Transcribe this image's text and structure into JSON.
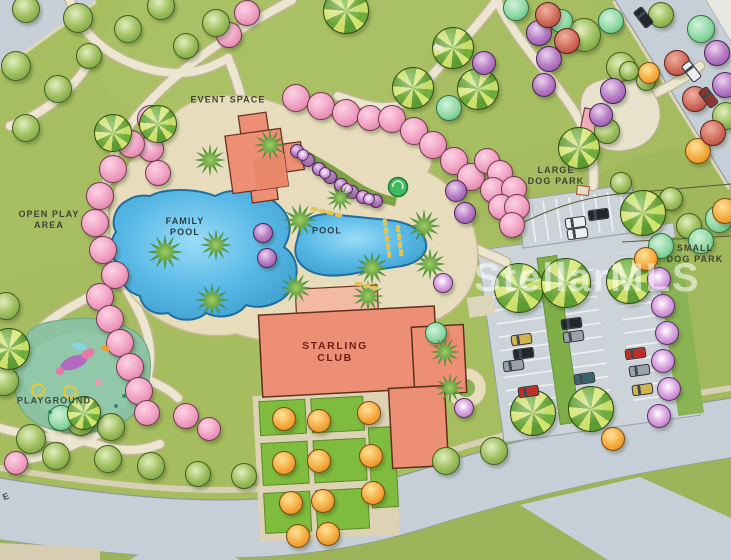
{
  "labels": {
    "event_space": "EVENT SPACE",
    "open_play_line1": "OPEN PLAY",
    "open_play_line2": "AREA",
    "family_pool_line1": "FAMILY",
    "family_pool_line2": "POOL",
    "pool": "POOL",
    "starling_club_line1": "STARLING",
    "starling_club_line2": "CLUB",
    "playground": "PLAYGROUND",
    "large_dog_park_line1": "LARGE",
    "large_dog_park_line2": "DOG PARK",
    "small_dog_park_line1": "SMALL",
    "small_dog_park_line2": "DOG PARK",
    "street_partial": "E",
    "watermark": "StellarMLS"
  },
  "colors": {
    "lawn": "#a6bd60",
    "verge": "#9cb35a",
    "road": "#c6cfd7",
    "lot": "#ccd4da",
    "deck": "#e7dcbb",
    "path": "#ece6d0",
    "water": "#57b8e6",
    "water_edge": "#1f6e9e",
    "building": "#ec8f74",
    "building_light": "#f2baa2",
    "building_stroke": "#5f2f1c",
    "playground": "#8cc2a2",
    "median_green": "#7fae48",
    "pink_tree": "#f3a8c8",
    "label_dark": "#3f4433",
    "label_pool": "#2c3b42",
    "label_club": "#6e2018",
    "label_playground": "#39503c",
    "watermark": "rgba(255,255,255,0.55)",
    "car_colors": {
      "yellow": "#d2b44a",
      "black": "#23272c",
      "gray": "#9aa1a8",
      "red": "#bf2e26",
      "teal": "#39646e",
      "white": "#eceef0",
      "darkred": "#8d3531"
    }
  },
  "trees": [
    {
      "t": "pink",
      "x": 295,
      "y": 97,
      "r": 13
    },
    {
      "t": "pink",
      "x": 320,
      "y": 105,
      "r": 13
    },
    {
      "t": "pink",
      "x": 345,
      "y": 112,
      "r": 13
    },
    {
      "t": "pink",
      "x": 369,
      "y": 117,
      "r": 12
    },
    {
      "t": "pink",
      "x": 391,
      "y": 118,
      "r": 13
    },
    {
      "t": "pink",
      "x": 413,
      "y": 130,
      "r": 13
    },
    {
      "t": "pink",
      "x": 432,
      "y": 144,
      "r": 13
    },
    {
      "t": "pink",
      "x": 453,
      "y": 160,
      "r": 13
    },
    {
      "t": "pink",
      "x": 470,
      "y": 176,
      "r": 13
    },
    {
      "t": "pink",
      "x": 486,
      "y": 160,
      "r": 12
    },
    {
      "t": "pink",
      "x": 499,
      "y": 172,
      "r": 12
    },
    {
      "t": "pink",
      "x": 492,
      "y": 189,
      "r": 12
    },
    {
      "t": "pink",
      "x": 513,
      "y": 188,
      "r": 12
    },
    {
      "t": "pink",
      "x": 500,
      "y": 206,
      "r": 12
    },
    {
      "t": "pink",
      "x": 516,
      "y": 206,
      "r": 12
    },
    {
      "t": "pink",
      "x": 511,
      "y": 224,
      "r": 12
    },
    {
      "t": "pink",
      "x": 246,
      "y": 12,
      "r": 12
    },
    {
      "t": "pink",
      "x": 228,
      "y": 34,
      "r": 12
    },
    {
      "t": "pink",
      "x": 150,
      "y": 148,
      "r": 12
    },
    {
      "t": "pink",
      "x": 157,
      "y": 172,
      "r": 12
    },
    {
      "t": "pink",
      "x": 150,
      "y": 118,
      "r": 13
    },
    {
      "t": "pink",
      "x": 130,
      "y": 143,
      "r": 13
    },
    {
      "t": "pink",
      "x": 112,
      "y": 168,
      "r": 13
    },
    {
      "t": "pink",
      "x": 99,
      "y": 195,
      "r": 13
    },
    {
      "t": "pink",
      "x": 94,
      "y": 222,
      "r": 13
    },
    {
      "t": "pink",
      "x": 102,
      "y": 249,
      "r": 13
    },
    {
      "t": "pink",
      "x": 114,
      "y": 274,
      "r": 13
    },
    {
      "t": "pink",
      "x": 99,
      "y": 296,
      "r": 13
    },
    {
      "t": "pink",
      "x": 109,
      "y": 318,
      "r": 13
    },
    {
      "t": "pink",
      "x": 119,
      "y": 342,
      "r": 13
    },
    {
      "t": "pink",
      "x": 129,
      "y": 366,
      "r": 13
    },
    {
      "t": "pink",
      "x": 138,
      "y": 390,
      "r": 13
    },
    {
      "t": "pink",
      "x": 146,
      "y": 412,
      "r": 12
    },
    {
      "t": "pink",
      "x": 185,
      "y": 415,
      "r": 12
    },
    {
      "t": "pink",
      "x": 208,
      "y": 428,
      "r": 11
    },
    {
      "t": "pink",
      "x": 15,
      "y": 462,
      "r": 11
    },
    {
      "t": "green",
      "x": 25,
      "y": 8,
      "r": 13
    },
    {
      "t": "green",
      "x": 77,
      "y": 17,
      "r": 14
    },
    {
      "t": "green",
      "x": 15,
      "y": 65,
      "r": 14
    },
    {
      "t": "green",
      "x": 57,
      "y": 88,
      "r": 13
    },
    {
      "t": "green",
      "x": 88,
      "y": 55,
      "r": 12
    },
    {
      "t": "green",
      "x": 127,
      "y": 28,
      "r": 13
    },
    {
      "t": "green",
      "x": 160,
      "y": 5,
      "r": 13
    },
    {
      "t": "green",
      "x": 25,
      "y": 127,
      "r": 13
    },
    {
      "t": "green",
      "x": 215,
      "y": 22,
      "r": 13
    },
    {
      "t": "green",
      "x": 185,
      "y": 45,
      "r": 12
    },
    {
      "t": "green",
      "x": 5,
      "y": 305,
      "r": 13
    },
    {
      "t": "green",
      "x": 3,
      "y": 380,
      "r": 14
    },
    {
      "t": "green",
      "x": 80,
      "y": 420,
      "r": 14
    },
    {
      "t": "green",
      "x": 110,
      "y": 426,
      "r": 13
    },
    {
      "t": "green",
      "x": 30,
      "y": 438,
      "r": 14
    },
    {
      "t": "green",
      "x": 55,
      "y": 455,
      "r": 13
    },
    {
      "t": "green",
      "x": 107,
      "y": 458,
      "r": 13
    },
    {
      "t": "green",
      "x": 150,
      "y": 465,
      "r": 13
    },
    {
      "t": "green",
      "x": 197,
      "y": 473,
      "r": 12
    },
    {
      "t": "green",
      "x": 243,
      "y": 475,
      "r": 12
    },
    {
      "t": "green",
      "x": 445,
      "y": 460,
      "r": 13
    },
    {
      "t": "green",
      "x": 493,
      "y": 450,
      "r": 13
    },
    {
      "t": "green",
      "x": 583,
      "y": 34,
      "r": 16
    },
    {
      "t": "green",
      "x": 620,
      "y": 66,
      "r": 14
    },
    {
      "t": "green",
      "x": 606,
      "y": 130,
      "r": 12
    },
    {
      "t": "green",
      "x": 725,
      "y": 115,
      "r": 13
    },
    {
      "t": "green",
      "x": 660,
      "y": 14,
      "r": 12
    },
    {
      "t": "green",
      "x": 620,
      "y": 182,
      "r": 10
    },
    {
      "t": "green",
      "x": 670,
      "y": 198,
      "r": 11
    },
    {
      "t": "green",
      "x": 688,
      "y": 225,
      "r": 12
    },
    {
      "t": "green",
      "x": 628,
      "y": 70,
      "r": 9
    },
    {
      "t": "green",
      "x": 645,
      "y": 80,
      "r": 9
    },
    {
      "t": "mint",
      "x": 448,
      "y": 107,
      "r": 12
    },
    {
      "t": "mint",
      "x": 515,
      "y": 7,
      "r": 12
    },
    {
      "t": "mint",
      "x": 610,
      "y": 20,
      "r": 12
    },
    {
      "t": "mint",
      "x": 700,
      "y": 28,
      "r": 13
    },
    {
      "t": "mint",
      "x": 718,
      "y": 218,
      "r": 13
    },
    {
      "t": "mint",
      "x": 700,
      "y": 240,
      "r": 12
    },
    {
      "t": "mint",
      "x": 660,
      "y": 245,
      "r": 12
    },
    {
      "t": "mint",
      "x": 435,
      "y": 332,
      "r": 10
    },
    {
      "t": "mint",
      "x": 60,
      "y": 417,
      "r": 12
    },
    {
      "t": "mint",
      "x": 560,
      "y": 20,
      "r": 11
    },
    {
      "t": "pinwheel",
      "x": 112,
      "y": 132,
      "r": 18
    },
    {
      "t": "pinwheel",
      "x": 157,
      "y": 123,
      "r": 18
    },
    {
      "t": "pinwheel",
      "x": 345,
      "y": 10,
      "r": 22
    },
    {
      "t": "pinwheel",
      "x": 452,
      "y": 47,
      "r": 20
    },
    {
      "t": "pinwheel",
      "x": 412,
      "y": 87,
      "r": 20
    },
    {
      "t": "pinwheel",
      "x": 477,
      "y": 88,
      "r": 20
    },
    {
      "t": "pinwheel",
      "x": 8,
      "y": 348,
      "r": 20
    },
    {
      "t": "pinwheel",
      "x": 83,
      "y": 412,
      "r": 16
    },
    {
      "t": "pinwheel",
      "x": 518,
      "y": 287,
      "r": 24
    },
    {
      "t": "pinwheel",
      "x": 565,
      "y": 282,
      "r": 24
    },
    {
      "t": "pinwheel",
      "x": 532,
      "y": 412,
      "r": 22
    },
    {
      "t": "pinwheel",
      "x": 590,
      "y": 408,
      "r": 22
    },
    {
      "t": "pinwheel",
      "x": 578,
      "y": 147,
      "r": 20
    },
    {
      "t": "pinwheel",
      "x": 642,
      "y": 212,
      "r": 22
    },
    {
      "t": "pinwheel",
      "x": 628,
      "y": 280,
      "r": 22
    },
    {
      "t": "purple",
      "x": 483,
      "y": 62,
      "r": 11
    },
    {
      "t": "purple",
      "x": 538,
      "y": 32,
      "r": 12
    },
    {
      "t": "purple",
      "x": 548,
      "y": 58,
      "r": 12
    },
    {
      "t": "purple",
      "x": 543,
      "y": 84,
      "r": 11
    },
    {
      "t": "purple",
      "x": 612,
      "y": 90,
      "r": 12
    },
    {
      "t": "purple",
      "x": 600,
      "y": 114,
      "r": 11
    },
    {
      "t": "purple",
      "x": 716,
      "y": 52,
      "r": 12
    },
    {
      "t": "purple",
      "x": 724,
      "y": 84,
      "r": 12
    },
    {
      "t": "purple",
      "x": 455,
      "y": 190,
      "r": 10
    },
    {
      "t": "purple",
      "x": 464,
      "y": 212,
      "r": 10
    },
    {
      "t": "purple",
      "x": 262,
      "y": 232,
      "r": 9
    },
    {
      "t": "purple",
      "x": 266,
      "y": 257,
      "r": 9
    },
    {
      "t": "purple",
      "x": 296,
      "y": 150,
      "r": 6
    },
    {
      "t": "purple",
      "x": 307,
      "y": 159,
      "r": 6
    },
    {
      "t": "purple",
      "x": 318,
      "y": 168,
      "r": 6
    },
    {
      "t": "purple",
      "x": 329,
      "y": 176,
      "r": 6
    },
    {
      "t": "purple",
      "x": 340,
      "y": 184,
      "r": 6
    },
    {
      "t": "purple",
      "x": 351,
      "y": 191,
      "r": 6
    },
    {
      "t": "purple",
      "x": 362,
      "y": 196,
      "r": 6
    },
    {
      "t": "purple",
      "x": 375,
      "y": 200,
      "r": 6
    },
    {
      "t": "pwhite",
      "x": 302,
      "y": 154,
      "r": 5
    },
    {
      "t": "pwhite",
      "x": 324,
      "y": 172,
      "r": 5
    },
    {
      "t": "pwhite",
      "x": 346,
      "y": 188,
      "r": 5
    },
    {
      "t": "pwhite",
      "x": 368,
      "y": 198,
      "r": 5
    },
    {
      "t": "pwhite",
      "x": 658,
      "y": 278,
      "r": 11
    },
    {
      "t": "pwhite",
      "x": 662,
      "y": 305,
      "r": 11
    },
    {
      "t": "pwhite",
      "x": 666,
      "y": 332,
      "r": 11
    },
    {
      "t": "pwhite",
      "x": 662,
      "y": 360,
      "r": 11
    },
    {
      "t": "pwhite",
      "x": 668,
      "y": 388,
      "r": 11
    },
    {
      "t": "pwhite",
      "x": 658,
      "y": 415,
      "r": 11
    },
    {
      "t": "pwhite",
      "x": 442,
      "y": 282,
      "r": 9
    },
    {
      "t": "pwhite",
      "x": 463,
      "y": 407,
      "r": 9
    },
    {
      "t": "orange",
      "x": 283,
      "y": 418,
      "r": 11
    },
    {
      "t": "orange",
      "x": 318,
      "y": 420,
      "r": 11
    },
    {
      "t": "orange",
      "x": 368,
      "y": 412,
      "r": 11
    },
    {
      "t": "orange",
      "x": 283,
      "y": 462,
      "r": 11
    },
    {
      "t": "orange",
      "x": 318,
      "y": 460,
      "r": 11
    },
    {
      "t": "orange",
      "x": 370,
      "y": 455,
      "r": 11
    },
    {
      "t": "orange",
      "x": 290,
      "y": 502,
      "r": 11
    },
    {
      "t": "orange",
      "x": 322,
      "y": 500,
      "r": 11
    },
    {
      "t": "orange",
      "x": 372,
      "y": 492,
      "r": 11
    },
    {
      "t": "orange",
      "x": 297,
      "y": 535,
      "r": 11
    },
    {
      "t": "orange",
      "x": 327,
      "y": 533,
      "r": 11
    },
    {
      "t": "orange",
      "x": 697,
      "y": 150,
      "r": 12
    },
    {
      "t": "orange",
      "x": 645,
      "y": 258,
      "r": 11
    },
    {
      "t": "orange",
      "x": 724,
      "y": 210,
      "r": 12
    },
    {
      "t": "orange",
      "x": 648,
      "y": 72,
      "r": 10
    },
    {
      "t": "orange",
      "x": 612,
      "y": 438,
      "r": 11
    },
    {
      "t": "red",
      "x": 547,
      "y": 14,
      "r": 12
    },
    {
      "t": "red",
      "x": 566,
      "y": 40,
      "r": 12
    },
    {
      "t": "red",
      "x": 676,
      "y": 62,
      "r": 12
    },
    {
      "t": "red",
      "x": 694,
      "y": 98,
      "r": 12
    },
    {
      "t": "red",
      "x": 712,
      "y": 132,
      "r": 12
    },
    {
      "t": "palm",
      "x": 300,
      "y": 220,
      "r": 17
    },
    {
      "t": "palm",
      "x": 340,
      "y": 198,
      "r": 14
    },
    {
      "t": "palm",
      "x": 372,
      "y": 268,
      "r": 17
    },
    {
      "t": "palm",
      "x": 424,
      "y": 226,
      "r": 17
    },
    {
      "t": "palm",
      "x": 430,
      "y": 264,
      "r": 16
    },
    {
      "t": "palm",
      "x": 368,
      "y": 296,
      "r": 16
    },
    {
      "t": "palm",
      "x": 296,
      "y": 288,
      "r": 16
    },
    {
      "t": "palm",
      "x": 165,
      "y": 252,
      "r": 18
    },
    {
      "t": "palm",
      "x": 216,
      "y": 245,
      "r": 16
    },
    {
      "t": "palm",
      "x": 212,
      "y": 300,
      "r": 17
    },
    {
      "t": "palm",
      "x": 210,
      "y": 160,
      "r": 16
    },
    {
      "t": "palm",
      "x": 270,
      "y": 145,
      "r": 16
    },
    {
      "t": "palm",
      "x": 445,
      "y": 352,
      "r": 15
    },
    {
      "t": "palm",
      "x": 450,
      "y": 388,
      "r": 15
    }
  ],
  "cars": [
    {
      "x": 520,
      "y": 338,
      "c": "yellow",
      "rot": -8
    },
    {
      "x": 522,
      "y": 352,
      "c": "black",
      "rot": -8
    },
    {
      "x": 512,
      "y": 364,
      "c": "gray",
      "rot": -8
    },
    {
      "x": 527,
      "y": 390,
      "c": "red",
      "rot": -8
    },
    {
      "x": 570,
      "y": 322,
      "c": "black",
      "rot": -8
    },
    {
      "x": 572,
      "y": 335,
      "c": "gray",
      "rot": -8
    },
    {
      "x": 583,
      "y": 377,
      "c": "teal",
      "rot": -8
    },
    {
      "x": 634,
      "y": 352,
      "c": "red",
      "rot": -8
    },
    {
      "x": 638,
      "y": 369,
      "c": "gray",
      "rot": -8
    },
    {
      "x": 641,
      "y": 388,
      "c": "yellow",
      "rot": -8
    },
    {
      "x": 574,
      "y": 221,
      "c": "white",
      "rot": -8
    },
    {
      "x": 597,
      "y": 213,
      "c": "black",
      "rot": -8
    },
    {
      "x": 576,
      "y": 232,
      "c": "white",
      "rot": -8
    },
    {
      "x": 642,
      "y": 16,
      "c": "black",
      "rot": 52
    },
    {
      "x": 690,
      "y": 70,
      "c": "white",
      "rot": 52
    },
    {
      "x": 707,
      "y": 96,
      "c": "darkred",
      "rot": 52
    }
  ],
  "decor": [
    {
      "k": "rect",
      "x": 314,
      "y": 209,
      "w": 7,
      "h": 4,
      "rot": 8,
      "c": "#e3c44f"
    },
    {
      "k": "rect",
      "x": 322,
      "y": 211,
      "w": 7,
      "h": 4,
      "rot": 8,
      "c": "#e3c44f"
    },
    {
      "k": "rect",
      "x": 330,
      "y": 213,
      "w": 7,
      "h": 4,
      "rot": 8,
      "c": "#e3c44f"
    },
    {
      "k": "rect",
      "x": 338,
      "y": 215,
      "w": 7,
      "h": 4,
      "rot": 8,
      "c": "#e3c44f"
    },
    {
      "k": "rect",
      "x": 358,
      "y": 284,
      "w": 7,
      "h": 4,
      "rot": 5,
      "c": "#e3c44f"
    },
    {
      "k": "rect",
      "x": 366,
      "y": 286,
      "w": 7,
      "h": 4,
      "rot": 5,
      "c": "#e3c44f"
    },
    {
      "k": "rect",
      "x": 374,
      "y": 288,
      "w": 7,
      "h": 4,
      "rot": 5,
      "c": "#e3c44f"
    },
    {
      "k": "rect",
      "x": 385,
      "y": 222,
      "w": 4,
      "h": 7,
      "rot": -4,
      "c": "#e3c44f"
    },
    {
      "k": "rect",
      "x": 386,
      "y": 230,
      "w": 4,
      "h": 7,
      "rot": -4,
      "c": "#e3c44f"
    },
    {
      "k": "rect",
      "x": 387,
      "y": 238,
      "w": 4,
      "h": 7,
      "rot": -4,
      "c": "#e3c44f"
    },
    {
      "k": "rect",
      "x": 388,
      "y": 246,
      "w": 4,
      "h": 7,
      "rot": -4,
      "c": "#e3c44f"
    },
    {
      "k": "rect",
      "x": 389,
      "y": 254,
      "w": 4,
      "h": 7,
      "rot": -4,
      "c": "#e3c44f"
    },
    {
      "k": "rect",
      "x": 398,
      "y": 228,
      "w": 4,
      "h": 7,
      "rot": -4,
      "c": "#e3c44f"
    },
    {
      "k": "rect",
      "x": 399,
      "y": 236,
      "w": 4,
      "h": 7,
      "rot": -4,
      "c": "#e3c44f"
    },
    {
      "k": "rect",
      "x": 400,
      "y": 244,
      "w": 4,
      "h": 7,
      "rot": -4,
      "c": "#e3c44f"
    },
    {
      "k": "rect",
      "x": 401,
      "y": 252,
      "w": 4,
      "h": 7,
      "rot": -4,
      "c": "#e3c44f"
    },
    {
      "k": "rect",
      "x": 74,
      "y": 362,
      "w": 28,
      "h": 13,
      "rot": -20,
      "c": "#b06ac0",
      "br": "50%"
    },
    {
      "k": "rect",
      "x": 88,
      "y": 353,
      "w": 14,
      "h": 9,
      "rot": -30,
      "c": "#e878a8",
      "br": "50%"
    },
    {
      "k": "rect",
      "x": 79,
      "y": 346,
      "w": 15,
      "h": 7,
      "rot": 15,
      "c": "#8ad4e8",
      "br": "50%"
    },
    {
      "k": "dot",
      "x": 60,
      "y": 371,
      "w": 8,
      "c": "#e878a8"
    },
    {
      "k": "ring",
      "x": 36,
      "y": 388,
      "w": 10,
      "c": "#e8c830"
    },
    {
      "k": "ring",
      "x": 68,
      "y": 390,
      "w": 10,
      "c": "#e8c830"
    },
    {
      "k": "dot",
      "x": 98,
      "y": 382,
      "w": 7,
      "c": "#f098b8"
    },
    {
      "k": "rect",
      "x": 105,
      "y": 348,
      "w": 9,
      "h": 5,
      "rot": 10,
      "c": "#e8a030",
      "br": "40%"
    },
    {
      "k": "dot",
      "x": 116,
      "y": 406,
      "w": 4,
      "c": "#2a8a6a"
    },
    {
      "k": "dot",
      "x": 124,
      "y": 396,
      "w": 4,
      "c": "#2a8a6a"
    },
    {
      "k": "dot",
      "x": 50,
      "y": 412,
      "w": 4,
      "c": "#2a8a6a"
    },
    {
      "k": "rect",
      "x": 438,
      "y": 47,
      "w": 9,
      "h": 5,
      "rot": 24,
      "c": "#eceadf"
    }
  ]
}
